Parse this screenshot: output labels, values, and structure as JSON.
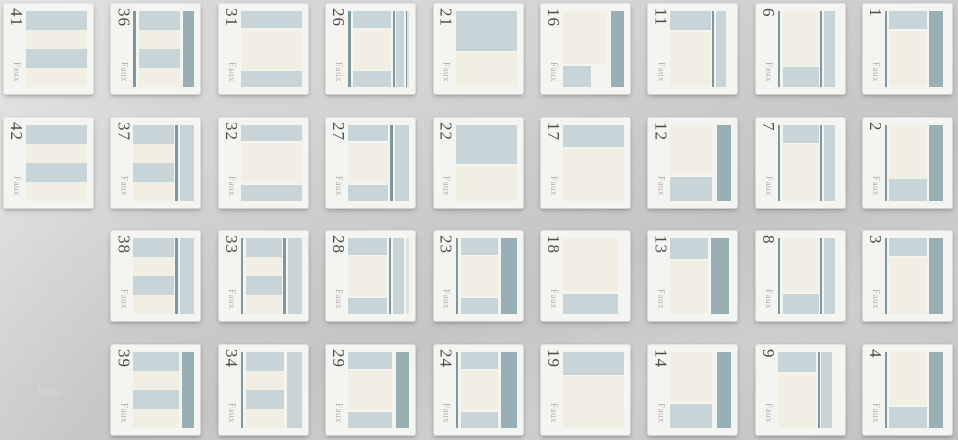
{
  "page": {
    "watermark": "http:"
  },
  "stamp_label": "Faux",
  "colors": {
    "blue": "#c7d4d8",
    "cream": "#f1efe3",
    "dark": "#97afb5",
    "line": "#7d989e",
    "blue_light": "#d9e2e4",
    "card": "#f4f4f1",
    "number_text": "#4d4d4d",
    "label_text": "#b2b0ac"
  },
  "preview_layouts": {
    "stripes": [
      [
        "blue",
        0,
        0,
        100,
        25
      ],
      [
        "cream",
        0,
        25,
        100,
        25
      ],
      [
        "blue",
        0,
        50,
        100,
        25
      ],
      [
        "cream",
        0,
        75,
        100,
        25
      ]
    ],
    "stripes-line-dark": [
      [
        "line",
        0,
        0,
        4,
        100
      ],
      [
        "blue",
        9,
        0,
        68,
        25
      ],
      [
        "cream",
        9,
        25,
        68,
        25
      ],
      [
        "blue",
        9,
        50,
        68,
        25
      ],
      [
        "cream",
        9,
        75,
        68,
        25
      ],
      [
        "dark",
        82,
        0,
        18,
        100
      ]
    ],
    "stripes-line-blue": [
      [
        "blue",
        0,
        0,
        66,
        25
      ],
      [
        "cream",
        0,
        25,
        66,
        25
      ],
      [
        "blue",
        0,
        50,
        66,
        25
      ],
      [
        "cream",
        0,
        75,
        66,
        25
      ],
      [
        "line",
        69,
        0,
        4,
        100
      ],
      [
        "blue",
        76,
        0,
        24,
        100
      ]
    ],
    "stripes-dark": [
      [
        "blue",
        0,
        0,
        74,
        25
      ],
      [
        "cream",
        0,
        25,
        74,
        25
      ],
      [
        "blue",
        0,
        50,
        74,
        25
      ],
      [
        "cream",
        0,
        75,
        74,
        25
      ],
      [
        "dark",
        80,
        0,
        20,
        100
      ]
    ],
    "line-stripes-blue": [
      [
        "line",
        0,
        0,
        4,
        100
      ],
      [
        "blue",
        9,
        0,
        62,
        25
      ],
      [
        "cream",
        9,
        25,
        62,
        25
      ],
      [
        "blue",
        9,
        50,
        62,
        25
      ],
      [
        "cream",
        9,
        75,
        62,
        25
      ],
      [
        "blue",
        76,
        0,
        24,
        100
      ]
    ],
    "line-stripes-line-blue": [
      [
        "line",
        0,
        0,
        4,
        100
      ],
      [
        "blue",
        9,
        0,
        58,
        25
      ],
      [
        "cream",
        9,
        25,
        58,
        25
      ],
      [
        "blue",
        9,
        50,
        58,
        25
      ],
      [
        "cream",
        9,
        75,
        58,
        25
      ],
      [
        "line",
        70,
        0,
        4,
        100
      ],
      [
        "blue",
        77,
        0,
        23,
        100
      ]
    ],
    "hcf": [
      [
        "blue",
        0,
        0,
        100,
        22
      ],
      [
        "cream",
        0,
        24,
        100,
        53
      ],
      [
        "blue",
        0,
        79,
        100,
        21
      ]
    ],
    "hcf-lines-sidebar": [
      [
        "line",
        0,
        0,
        4,
        100
      ],
      [
        "blue",
        8,
        0,
        62,
        22
      ],
      [
        "cream",
        8,
        24,
        62,
        53
      ],
      [
        "blue",
        8,
        79,
        62,
        21
      ],
      [
        "line",
        73,
        0,
        3,
        100
      ],
      [
        "blue",
        79,
        0,
        13,
        100
      ],
      [
        "line",
        94,
        0,
        2,
        100
      ],
      [
        "blue_light",
        97,
        0,
        3,
        100
      ]
    ],
    "hcf-line-blue": [
      [
        "blue",
        0,
        0,
        66,
        22
      ],
      [
        "cream",
        0,
        24,
        66,
        53
      ],
      [
        "blue",
        0,
        79,
        66,
        21
      ],
      [
        "line",
        69,
        0,
        4,
        100
      ],
      [
        "blue",
        76,
        0,
        24,
        100
      ]
    ],
    "hcf-line-blue-strip": [
      [
        "blue",
        0,
        0,
        64,
        22
      ],
      [
        "cream",
        0,
        24,
        64,
        53
      ],
      [
        "blue",
        0,
        79,
        64,
        21
      ],
      [
        "line",
        67,
        0,
        4,
        100
      ],
      [
        "blue",
        74,
        0,
        18,
        100
      ],
      [
        "blue_light",
        95,
        0,
        5,
        100
      ]
    ],
    "hcf-dark": [
      [
        "blue",
        0,
        0,
        72,
        22
      ],
      [
        "cream",
        0,
        24,
        72,
        53
      ],
      [
        "blue",
        0,
        79,
        72,
        21
      ],
      [
        "dark",
        78,
        0,
        22,
        100
      ]
    ],
    "header-tall": [
      [
        "blue",
        0,
        0,
        100,
        52
      ],
      [
        "cream",
        0,
        54,
        100,
        46
      ]
    ],
    "line-hcf-dark": [
      [
        "line",
        0,
        0,
        4,
        100
      ],
      [
        "blue",
        9,
        0,
        60,
        22
      ],
      [
        "cream",
        9,
        24,
        60,
        53
      ],
      [
        "blue",
        9,
        79,
        60,
        21
      ],
      [
        "dark",
        74,
        0,
        26,
        100
      ]
    ],
    "content-footer-dark-sm": [
      [
        "cream",
        0,
        0,
        72,
        70
      ],
      [
        "blue",
        0,
        73,
        46,
        27
      ],
      [
        "dark",
        78,
        0,
        22,
        100
      ]
    ],
    "header-sm": [
      [
        "blue",
        0,
        0,
        100,
        30
      ],
      [
        "cream",
        0,
        32,
        100,
        68
      ]
    ],
    "content-footer": [
      [
        "cream",
        0,
        0,
        90,
        70
      ],
      [
        "blue",
        0,
        73,
        90,
        27
      ]
    ],
    "header-line-blue": [
      [
        "blue",
        0,
        0,
        66,
        25
      ],
      [
        "cream",
        0,
        27,
        66,
        73
      ],
      [
        "line",
        69,
        0,
        3,
        100
      ],
      [
        "blue",
        74,
        0,
        18,
        100
      ]
    ],
    "content-footer-dark": [
      [
        "cream",
        0,
        0,
        68,
        66
      ],
      [
        "blue",
        0,
        69,
        68,
        31
      ],
      [
        "dark",
        76,
        0,
        24,
        100
      ]
    ],
    "header-dark": [
      [
        "blue",
        0,
        0,
        62,
        28
      ],
      [
        "cream",
        0,
        30,
        62,
        70
      ],
      [
        "dark",
        66,
        0,
        30,
        100
      ]
    ],
    "line-cf-line-blue": [
      [
        "line",
        0,
        0,
        4,
        100
      ],
      [
        "cream",
        9,
        0,
        58,
        72
      ],
      [
        "blue",
        9,
        74,
        58,
        26
      ],
      [
        "line",
        70,
        0,
        3,
        100
      ],
      [
        "blue",
        76,
        0,
        17,
        100
      ]
    ],
    "line-h-line-blue": [
      [
        "line",
        0,
        0,
        4,
        100
      ],
      [
        "blue",
        9,
        0,
        58,
        24
      ],
      [
        "cream",
        9,
        26,
        58,
        74
      ],
      [
        "line",
        70,
        0,
        3,
        100
      ],
      [
        "blue",
        76,
        0,
        18,
        100
      ]
    ],
    "h-line-blue": [
      [
        "blue",
        0,
        0,
        62,
        26
      ],
      [
        "cream",
        0,
        28,
        62,
        72
      ],
      [
        "line",
        66,
        0,
        3,
        100
      ],
      [
        "blue",
        71,
        0,
        18,
        100
      ]
    ],
    "line-h-dark": [
      [
        "line",
        0,
        0,
        3,
        100
      ],
      [
        "blue",
        7,
        0,
        62,
        24
      ],
      [
        "cream",
        7,
        26,
        62,
        74
      ],
      [
        "dark",
        72,
        0,
        22,
        100
      ]
    ],
    "line-cf-dark": [
      [
        "line",
        0,
        0,
        3,
        100
      ],
      [
        "cream",
        7,
        0,
        62,
        70
      ],
      [
        "blue",
        7,
        72,
        62,
        28
      ],
      [
        "dark",
        72,
        0,
        22,
        100
      ]
    ]
  },
  "tiles": [
    {
      "number": "41",
      "row": 0,
      "col": 0,
      "layout": "stripes"
    },
    {
      "number": "36",
      "row": 0,
      "col": 1,
      "layout": "stripes-line-dark"
    },
    {
      "number": "31",
      "row": 0,
      "col": 2,
      "layout": "hcf"
    },
    {
      "number": "26",
      "row": 0,
      "col": 3,
      "layout": "hcf-lines-sidebar"
    },
    {
      "number": "21",
      "row": 0,
      "col": 4,
      "layout": "header-tall"
    },
    {
      "number": "16",
      "row": 0,
      "col": 5,
      "layout": "content-footer-dark-sm"
    },
    {
      "number": "11",
      "row": 0,
      "col": 6,
      "layout": "header-line-blue"
    },
    {
      "number": "6",
      "row": 0,
      "col": 7,
      "layout": "line-cf-line-blue"
    },
    {
      "number": "1",
      "row": 0,
      "col": 8,
      "layout": "line-h-dark"
    },
    {
      "number": "42",
      "row": 1,
      "col": 0,
      "layout": "stripes"
    },
    {
      "number": "37",
      "row": 1,
      "col": 1,
      "layout": "stripes-line-blue"
    },
    {
      "number": "32",
      "row": 1,
      "col": 2,
      "layout": "hcf"
    },
    {
      "number": "27",
      "row": 1,
      "col": 3,
      "layout": "hcf-line-blue"
    },
    {
      "number": "22",
      "row": 1,
      "col": 4,
      "layout": "header-tall"
    },
    {
      "number": "17",
      "row": 1,
      "col": 5,
      "layout": "header-sm"
    },
    {
      "number": "12",
      "row": 1,
      "col": 6,
      "layout": "content-footer-dark"
    },
    {
      "number": "7",
      "row": 1,
      "col": 7,
      "layout": "line-h-line-blue"
    },
    {
      "number": "2",
      "row": 1,
      "col": 8,
      "layout": "line-cf-dark"
    },
    {
      "number": "38",
      "row": 2,
      "col": 1,
      "layout": "stripes-line-blue"
    },
    {
      "number": "33",
      "row": 2,
      "col": 2,
      "layout": "line-stripes-line-blue"
    },
    {
      "number": "28",
      "row": 2,
      "col": 3,
      "layout": "hcf-line-blue-strip"
    },
    {
      "number": "23",
      "row": 2,
      "col": 4,
      "layout": "line-hcf-dark"
    },
    {
      "number": "18",
      "row": 2,
      "col": 5,
      "layout": "content-footer"
    },
    {
      "number": "13",
      "row": 2,
      "col": 6,
      "layout": "header-dark"
    },
    {
      "number": "8",
      "row": 2,
      "col": 7,
      "layout": "line-cf-line-blue"
    },
    {
      "number": "3",
      "row": 2,
      "col": 8,
      "layout": "line-h-dark"
    },
    {
      "number": "39",
      "row": 3,
      "col": 1,
      "layout": "stripes-dark"
    },
    {
      "number": "34",
      "row": 3,
      "col": 2,
      "layout": "line-stripes-blue"
    },
    {
      "number": "29",
      "row": 3,
      "col": 3,
      "layout": "hcf-dark"
    },
    {
      "number": "24",
      "row": 3,
      "col": 4,
      "layout": "line-hcf-dark"
    },
    {
      "number": "19",
      "row": 3,
      "col": 5,
      "layout": "header-sm"
    },
    {
      "number": "14",
      "row": 3,
      "col": 6,
      "layout": "content-footer-dark"
    },
    {
      "number": "9",
      "row": 3,
      "col": 7,
      "layout": "h-line-blue"
    },
    {
      "number": "4",
      "row": 3,
      "col": 8,
      "layout": "line-cf-dark"
    }
  ],
  "grid": {
    "origin_x": 4,
    "origin_y": 4,
    "pitch_x": 107.4,
    "pitch_y": 113.6,
    "tile_w": 89,
    "tile_h": 90
  }
}
